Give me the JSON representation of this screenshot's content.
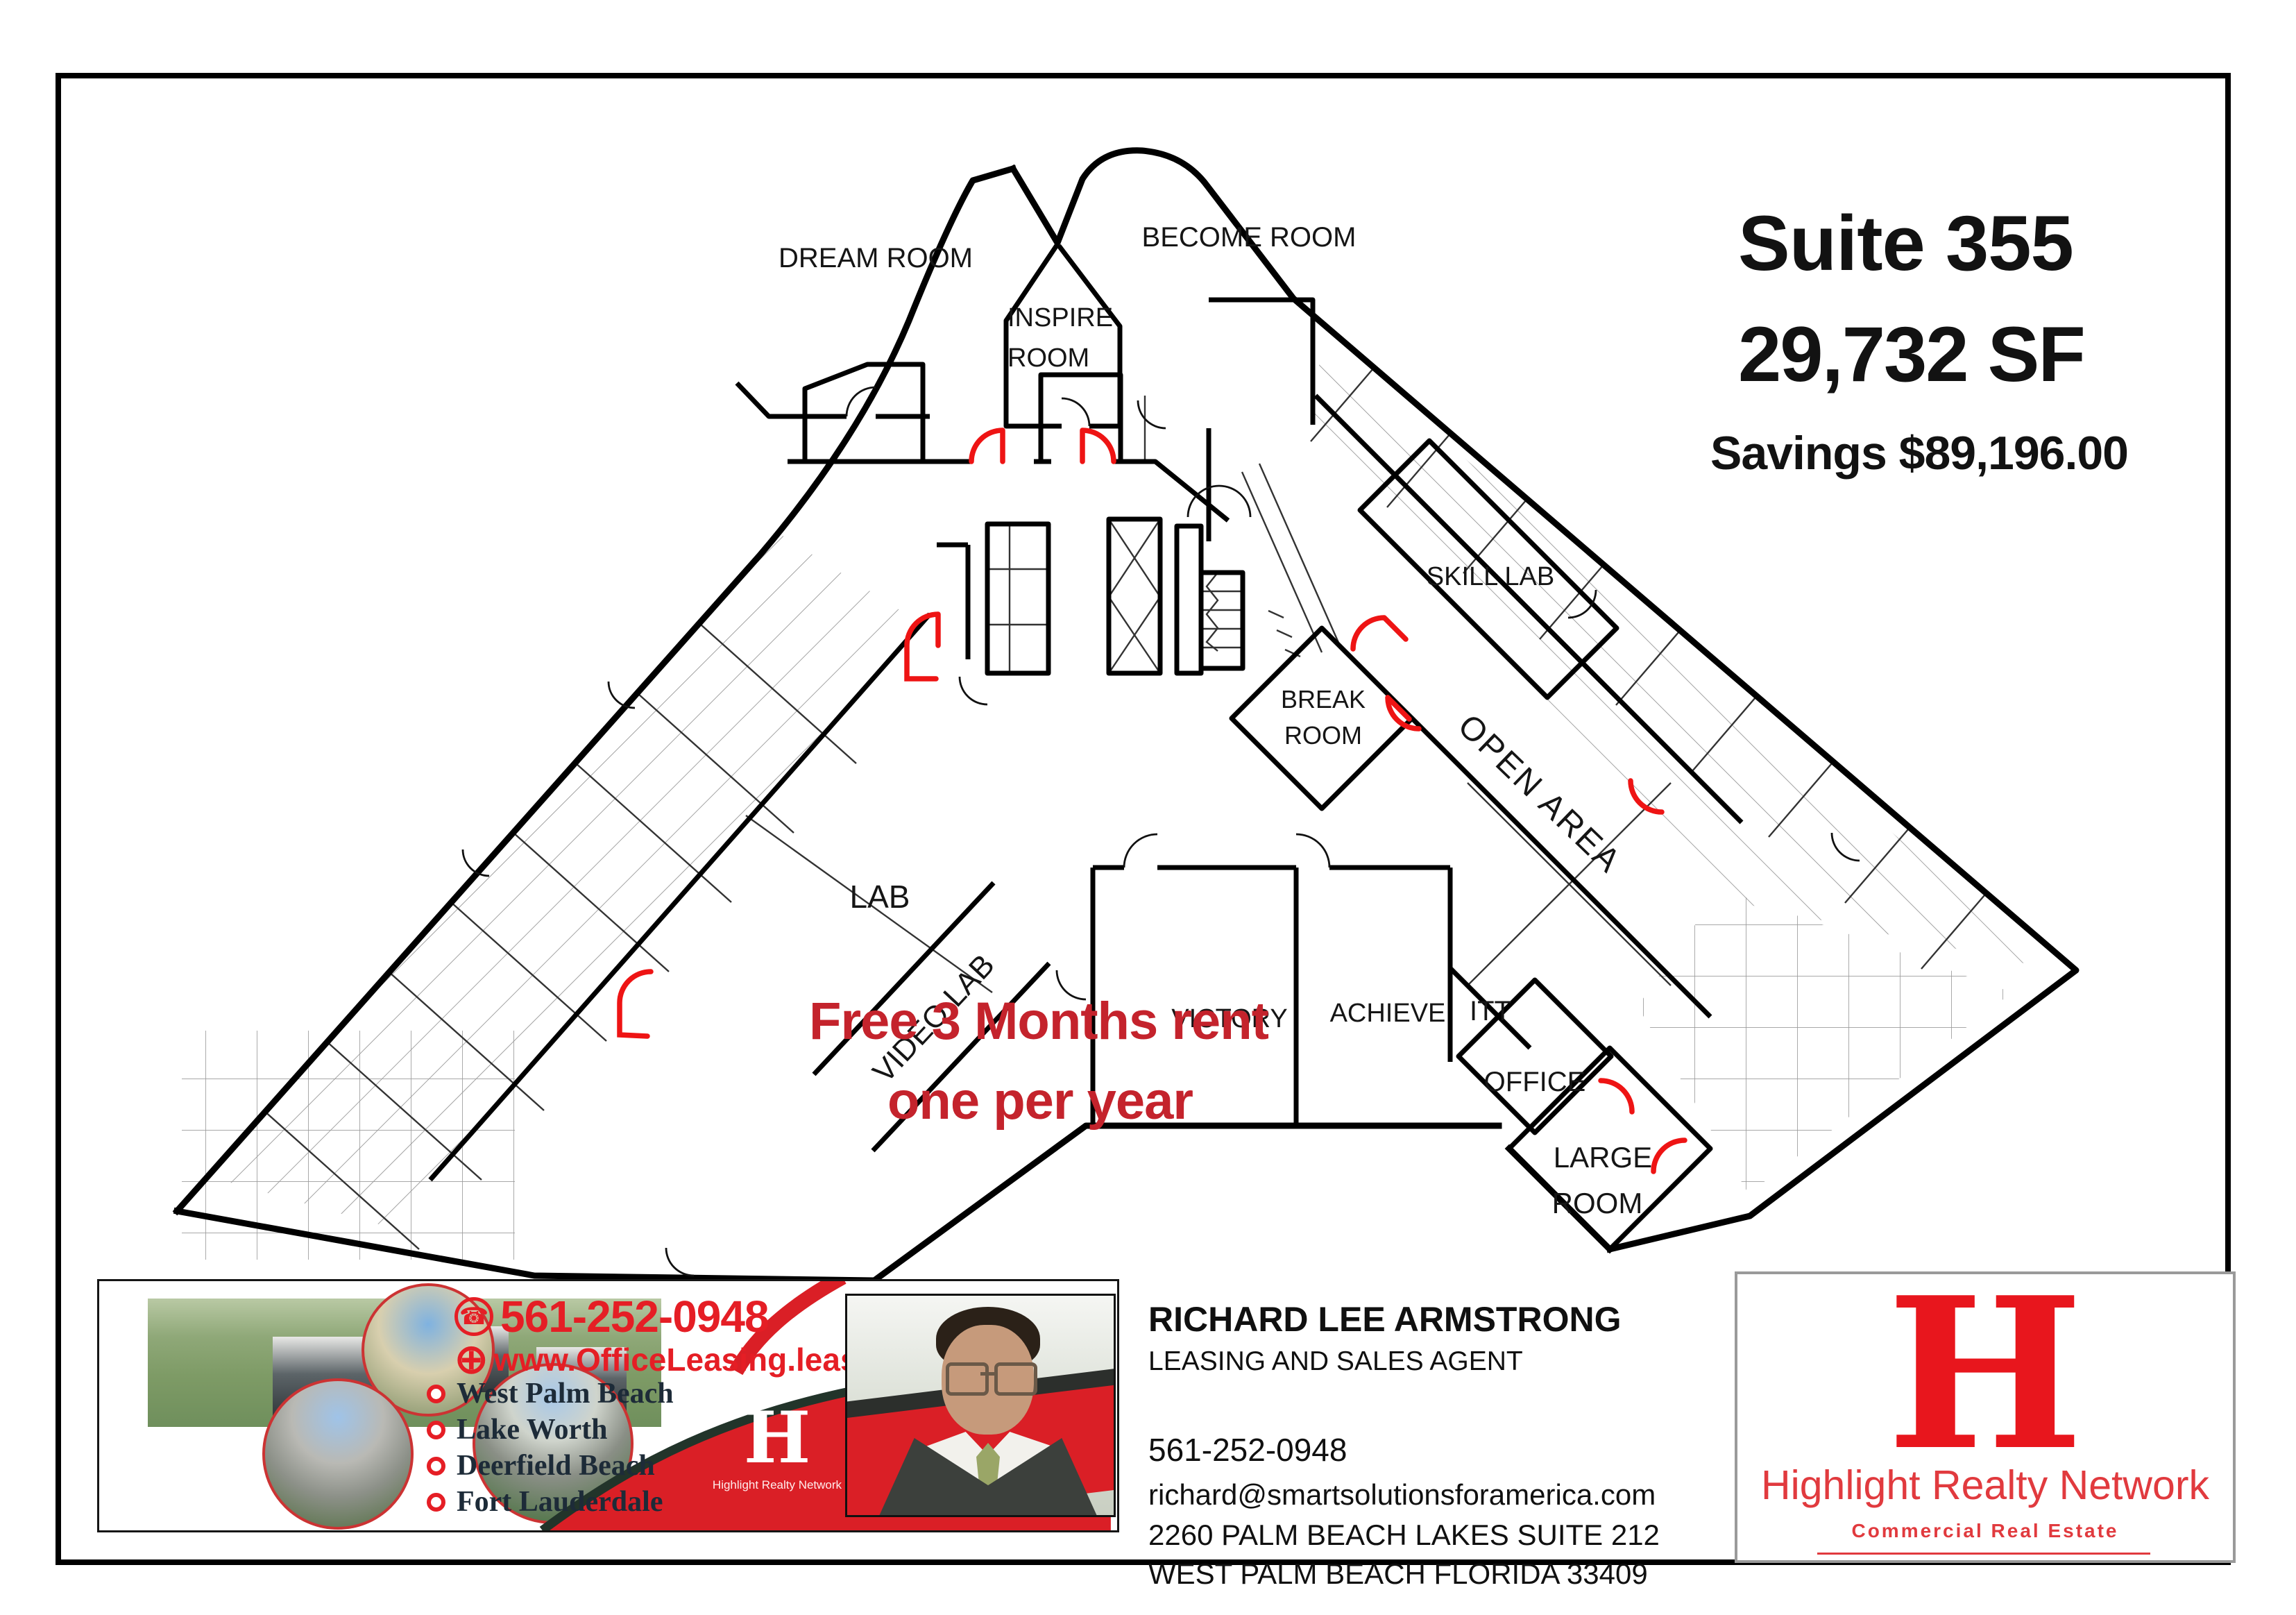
{
  "plan": {
    "suite_title": "Suite 355",
    "suite_size": "29,732 SF",
    "suite_savings": "Savings $89,196.00",
    "promo_line1": "Free 3 Months rent",
    "promo_line2": "one per year",
    "rooms": {
      "dream": "DREAM ROOM",
      "become": "BECOME ROOM",
      "inspire_line1": "INSPIRE",
      "inspire_line2": "ROOM",
      "skill": "SKILL LAB",
      "break_line1": "BREAK",
      "break_line2": "ROOM",
      "open_area": "OPEN AREA",
      "lab": "LAB",
      "video_lab": "VIDEO LAB",
      "victory": "VICTORY",
      "achieve": "ACHIEVE",
      "itt": "ITT",
      "office": "OFFICE",
      "large_line1": "LARGE",
      "large_line2": "ROOM"
    }
  },
  "banner": {
    "phone": "561-252-0948",
    "phone_icon": "☎",
    "globe_icon": "⊕",
    "website": "www.OfficeLeasing.lease",
    "cities": [
      "West Palm Beach",
      "Lake Worth",
      "Deerfield Beach",
      "Fort Lauderdale"
    ],
    "logo_letter": "H",
    "logo_caption": "Highlight Realty Network"
  },
  "agent": {
    "name": "RICHARD LEE ARMSTRONG",
    "title": "LEASING AND SALES AGENT",
    "phone": "561-252-0948",
    "email": "richard@smartsolutionsforamerica.com",
    "address1": "2260 PALM BEACH LAKES SUITE 212",
    "address2": "WEST PALM BEACH FLORIDA  33409"
  },
  "brand": {
    "letter": "H",
    "name": "Highlight Realty Network",
    "tagline": "Commercial Real Estate"
  },
  "colors": {
    "wall_black": "#000000",
    "door_red": "#ee1414",
    "promo_red": "#c4232c",
    "banner_red": "#e51e25",
    "swoosh_red": "#da1f26",
    "brand_red": "#e8161d",
    "city_navy": "#1d2b38",
    "brand_border_gray": "#9a9a9a"
  }
}
